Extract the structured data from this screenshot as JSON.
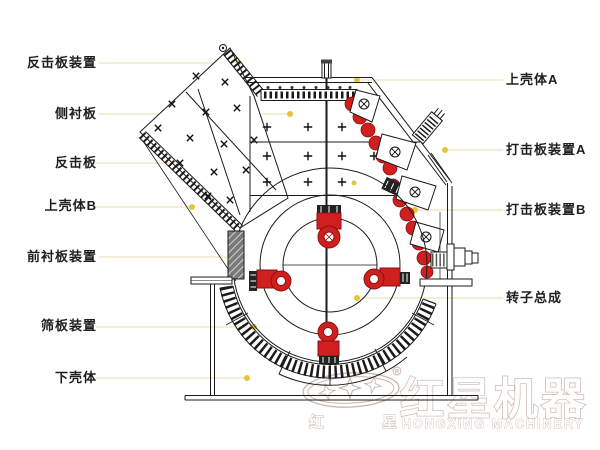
{
  "diagram_title": "impact-crusher-structure-diagram",
  "labels": {
    "left": [
      {
        "text": "反击板装置"
      },
      {
        "text": "侧衬板"
      },
      {
        "text": "反击板"
      },
      {
        "text": "上壳体B"
      },
      {
        "text": "前衬板装置"
      },
      {
        "text": "筛板装置"
      },
      {
        "text": "下壳体"
      }
    ],
    "right": [
      {
        "text": "上壳体A"
      },
      {
        "text": "打击板装置A"
      },
      {
        "text": "打击板装置B"
      },
      {
        "text": "转子总成"
      }
    ]
  },
  "logo": {
    "zh_small_left": "红",
    "zh_small_right": "星",
    "zh_main": "红星机器",
    "en": "HONGXING MACHINERY",
    "registered": "R"
  },
  "colors": {
    "red": "#d01f1f",
    "red_dark": "#8e0f0f",
    "line": "#1b1b1b",
    "leader_line": "#ece5bd",
    "leader_dot": "#e7c33a",
    "logo_stroke": "#c9b6ad"
  }
}
